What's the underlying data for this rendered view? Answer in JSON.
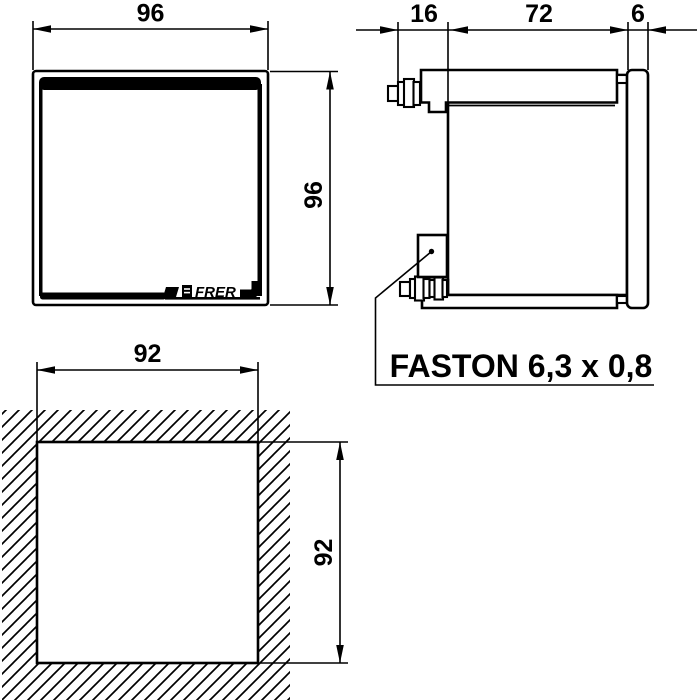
{
  "colors": {
    "line": "#000000",
    "background": "#ffffff"
  },
  "front_view": {
    "width_mm": "96",
    "height_mm": "96",
    "brand": "FRER"
  },
  "side_view": {
    "terminal_protrusion_mm": "16",
    "body_depth_mm": "72",
    "bezel_depth_mm": "6",
    "terminal_note": "FASTON 6,3 x 0,8"
  },
  "panel_cutout": {
    "width_mm": "92",
    "height_mm": "92"
  }
}
